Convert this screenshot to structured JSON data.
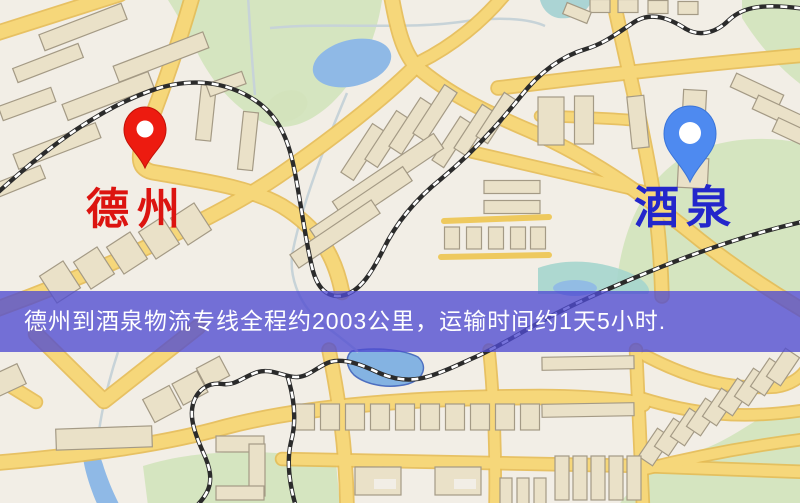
{
  "map": {
    "origin": {
      "name": "德州",
      "pin_color": "#ed1b10",
      "label_color": "#dc1410"
    },
    "destination": {
      "name": "酒泉",
      "pin_color": "#4e8af0",
      "label_color": "#2326cb"
    },
    "banner": {
      "text": "德州到酒泉物流专线全程约2003公里，运输时间约1天5小时.",
      "background_color": "rgba(79,76,209,0.78)",
      "text_color": "#ffffff"
    },
    "route": {
      "distance_km": "2003",
      "duration": "1天5小时"
    },
    "palette": {
      "background": "#f2eee6",
      "road_fill": "#f6d77a",
      "road_casing": "#e6bb54",
      "building": "#eae1c8",
      "park": "#d2e3bb",
      "water": "#8fb9e6",
      "railway": "#2b2b2b"
    }
  }
}
